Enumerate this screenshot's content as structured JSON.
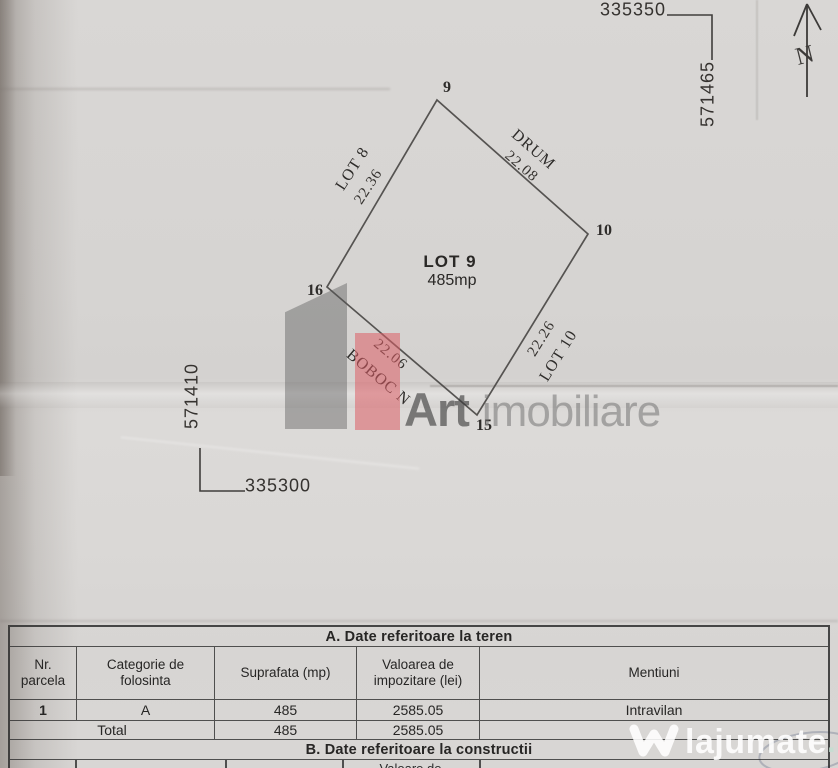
{
  "plan": {
    "grid": {
      "top_x_label": "335350",
      "top_y_label": "571465",
      "left_y_label": "571410",
      "left_x_label": "335300"
    },
    "north_label": "N",
    "lot": {
      "name": "LOT 9",
      "area": "485mp",
      "vertices": [
        {
          "id": "9"
        },
        {
          "id": "10"
        },
        {
          "id": "15"
        },
        {
          "id": "16"
        }
      ],
      "edges": [
        {
          "neighbor": "LOT 8",
          "length": "22.36"
        },
        {
          "neighbor": "DRUM",
          "length": "22.08"
        },
        {
          "neighbor": "LOT 10",
          "length": "22.26"
        },
        {
          "neighbor": "BOBOC N",
          "length": "22.06"
        }
      ]
    }
  },
  "watermarks": {
    "art_imobiliare": {
      "word1": "Art",
      "word2": "imobiliare",
      "accent_color": "#dd5f66"
    },
    "lajumate": {
      "name": "lajumate",
      "tld": ".ro"
    }
  },
  "table": {
    "section_a_title": "A. Date referitoare la teren",
    "columns": [
      "Nr. parcela",
      "Categorie de folosinta",
      "Suprafata (mp)",
      "Valoarea de impozitare (lei)",
      "Mentiuni"
    ],
    "rows": [
      {
        "nr": "1",
        "categorie": "A",
        "suprafata": "485",
        "valoare": "2585.05",
        "mentiuni": "Intravilan"
      }
    ],
    "total_row": {
      "label": "Total",
      "suprafata": "485",
      "valoare": "2585.05"
    },
    "section_b_title": "B. Date referitoare la constructii",
    "partial_next_header": "Valoare de"
  },
  "colors": {
    "paper": "#d7d5d3",
    "ink": "#3f3d3b"
  }
}
